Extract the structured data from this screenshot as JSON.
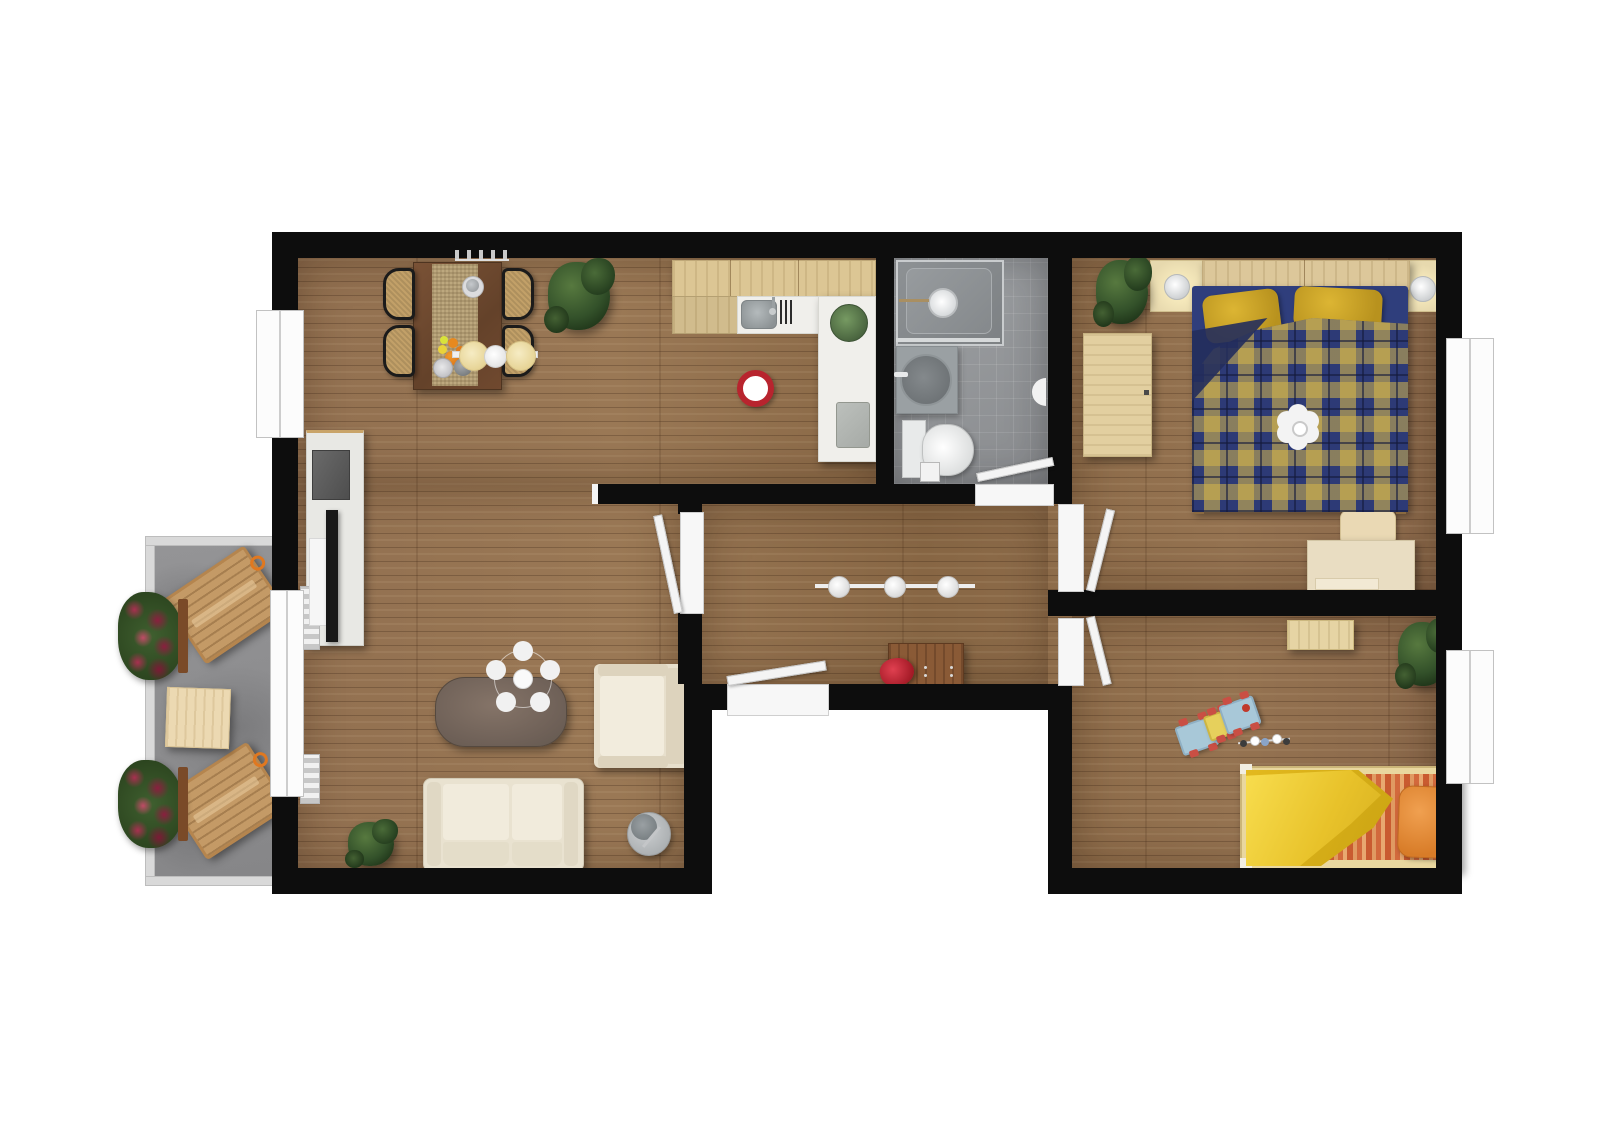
{
  "meta": {
    "title": "Apartment floor plan – rendered top view",
    "type": "3d-floor-plan",
    "scale_text": ""
  },
  "colors": {
    "wall": "#0d0d0d",
    "floor_wood": "#8d6a49",
    "bathroom_tile": "#96989a",
    "balcony_stone": "#8e8e90",
    "kitchen_wood": "#dcc694",
    "counter_white": "#f0efeb",
    "duvet_navy": "#2f3e7c",
    "duvet_gold": "#c9a93e",
    "pillow_mustard": "#c9a227",
    "kids_blanket_yellow": "#f4d33c",
    "kids_mattress_orange": "#d2693c",
    "sofa_cream": "#eae3d1",
    "accent_red": "#c0392b",
    "flower_red": "#8b1f3f",
    "lounger_wood": "#c49a66"
  },
  "rooms": [
    {
      "id": "living-dining",
      "label": "Living / dining room with open kitchen",
      "items": [
        "dining-table",
        "table-runner",
        "dining-chairs",
        "pendant-lamp",
        "fruit",
        "tableware",
        "wall-shelf-items",
        "potted-plant",
        "kitchen-cabinets",
        "kitchen-sink",
        "dish-rack",
        "kitchen-counter",
        "fruit-bowl",
        "cutting-board",
        "pet-bowl",
        "tv-sideboard",
        "speaker",
        "tv",
        "radiator",
        "coffee-table",
        "ceiling-lamp",
        "armchair",
        "sofa",
        "floor-lamp",
        "small-plant"
      ]
    },
    {
      "id": "bathroom",
      "label": "Bathroom",
      "items": [
        "shower",
        "shower-head",
        "washbasin",
        "toilet",
        "bathroom-bin",
        "wall-light",
        "bathroom-door"
      ]
    },
    {
      "id": "hallway",
      "label": "Hallway",
      "items": [
        "ceiling-light-rail",
        "sideboard",
        "red-bag",
        "entry-door"
      ]
    },
    {
      "id": "bedroom",
      "label": "Bedroom",
      "items": [
        "headboard-shelf",
        "nightstand-lamps",
        "double-bed",
        "pillows",
        "plaid-duvet",
        "ceiling-flower-lamp",
        "side-table",
        "desk",
        "desk-chair",
        "potted-plant",
        "window"
      ]
    },
    {
      "id": "kids-room",
      "label": "Kids room",
      "items": [
        "toy-train",
        "toy-figures",
        "single-bed",
        "yellow-blanket",
        "orange-pillow",
        "wardrobe-shelf",
        "potted-plant",
        "window"
      ]
    },
    {
      "id": "balcony",
      "label": "Balcony",
      "items": [
        "deck-chair",
        "deck-chair",
        "side-table",
        "flower-box",
        "flower-box",
        "railing"
      ]
    }
  ]
}
